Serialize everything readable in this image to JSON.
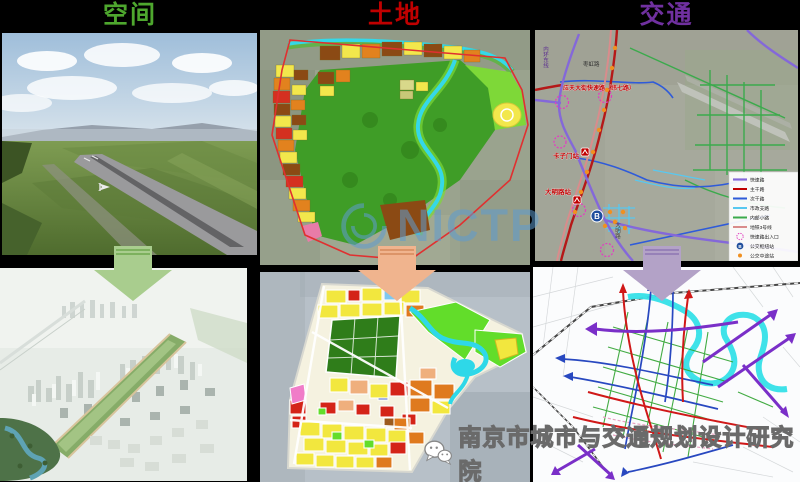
{
  "header": {
    "titles": [
      {
        "label": "空间",
        "color": "#4EA72E"
      },
      {
        "label": "土地",
        "color": "#C00000"
      },
      {
        "label": "交通",
        "color": "#7030A0"
      }
    ]
  },
  "arrows": [
    {
      "fill": "#A9CD8E",
      "stroke": "#6FA84F"
    },
    {
      "fill": "#F0B48E",
      "stroke": "#D68A5C"
    },
    {
      "fill": "#B3A2C7",
      "stroke": "#8E76B4"
    }
  ],
  "transport_map": {
    "labels": {
      "ring_road": "内环东线",
      "zaohong_road": "枣虹路",
      "yingtian_expressway": "应天大街快速路（纬七路）",
      "kazimen_station": "卡子门站",
      "daminglu_station": "大明路站",
      "daming_road": "大明路",
      "hub_glyph": "B"
    },
    "legend": {
      "items": [
        {
          "label": "快速路",
          "color": "#8468D9"
        },
        {
          "label": "主干路",
          "color": "#C00000"
        },
        {
          "label": "次干路",
          "color": "#2F5BD9"
        },
        {
          "label": "市政支路",
          "color": "#58C8F0"
        },
        {
          "label": "内部小路",
          "color": "#3BAA4C"
        },
        {
          "label": "地铁3号线",
          "color": "#D98C8C"
        },
        {
          "label": "快速路出入口",
          "color": "#E040C0"
        },
        {
          "label": "公交枢纽站",
          "color": "#1F4E9C",
          "glyph": "B"
        },
        {
          "label": "公交中途站",
          "color": "#F09020"
        }
      ]
    }
  },
  "watermarks": {
    "brand": "NICTP",
    "brand_color": "#5E9CD0",
    "footer": "南京市城市与交通规划设计研究院"
  }
}
